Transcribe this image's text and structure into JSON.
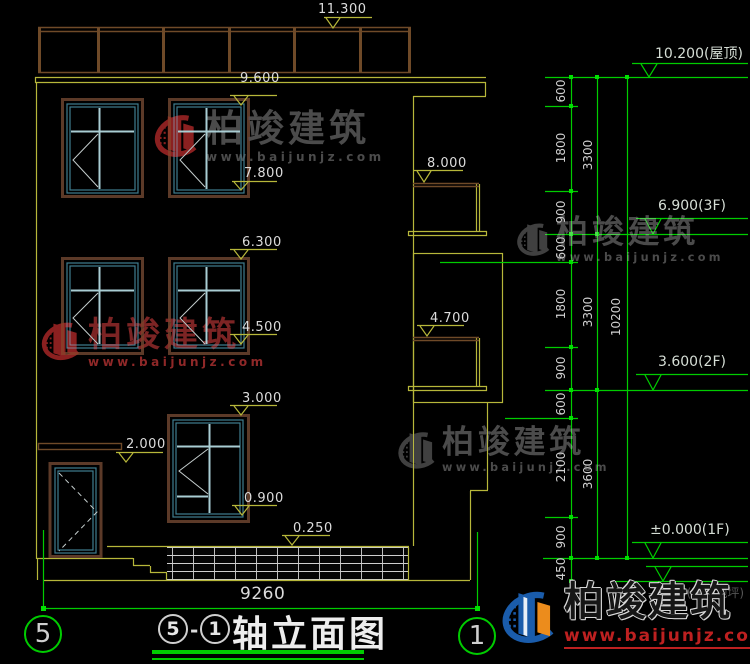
{
  "left_markers": {
    "m11300": "11.300",
    "m9600": "9.600",
    "m7800": "7.800",
    "m8000": "8.000",
    "m6300": "6.300",
    "m4500": "4.500",
    "m4700": "4.700",
    "m3000": "3.000",
    "m2000": "2.000",
    "m0900": "0.900",
    "m0250": "0.250"
  },
  "right_levels": {
    "roof": "10.200(屋顶)",
    "f3": "6.900(3F)",
    "f2": "3.600(2F)",
    "f1": "±0.000(1F)",
    "outdoor": "-0.450(室外地坪)"
  },
  "chain": {
    "c600a": "600",
    "c1800a": "1800",
    "c900a": "900",
    "c600b": "600",
    "c1800b": "1800",
    "c900b": "900",
    "c600c": "600",
    "c2100": "2100",
    "c900c": "900",
    "c450": "450",
    "c3300a": "3300",
    "c3300b": "3300",
    "c3600": "3600",
    "c10200": "10200"
  },
  "title_block": {
    "bottom_dimension": "9260",
    "axis_bubble_left": "5",
    "axis_bubble_right": "1",
    "circle_left": "5",
    "separator": "-",
    "circle_right": "1",
    "title_text": "轴立面图"
  },
  "watermark": {
    "brand": "柏竣建筑",
    "url": "www.baijunjz.com"
  },
  "footer_logo": {
    "brand": "柏竣建筑",
    "url": "www.baijunjz.com"
  },
  "colors": {
    "dim_green": "#00cc00",
    "cad_yellow": "#b7b73a",
    "frame_brown": "#5c3a28",
    "window_teal": "#3f7d8f",
    "logo_blue": "#1a5cab",
    "logo_orange": "#ec8c1c",
    "url_red": "#bd2020"
  }
}
